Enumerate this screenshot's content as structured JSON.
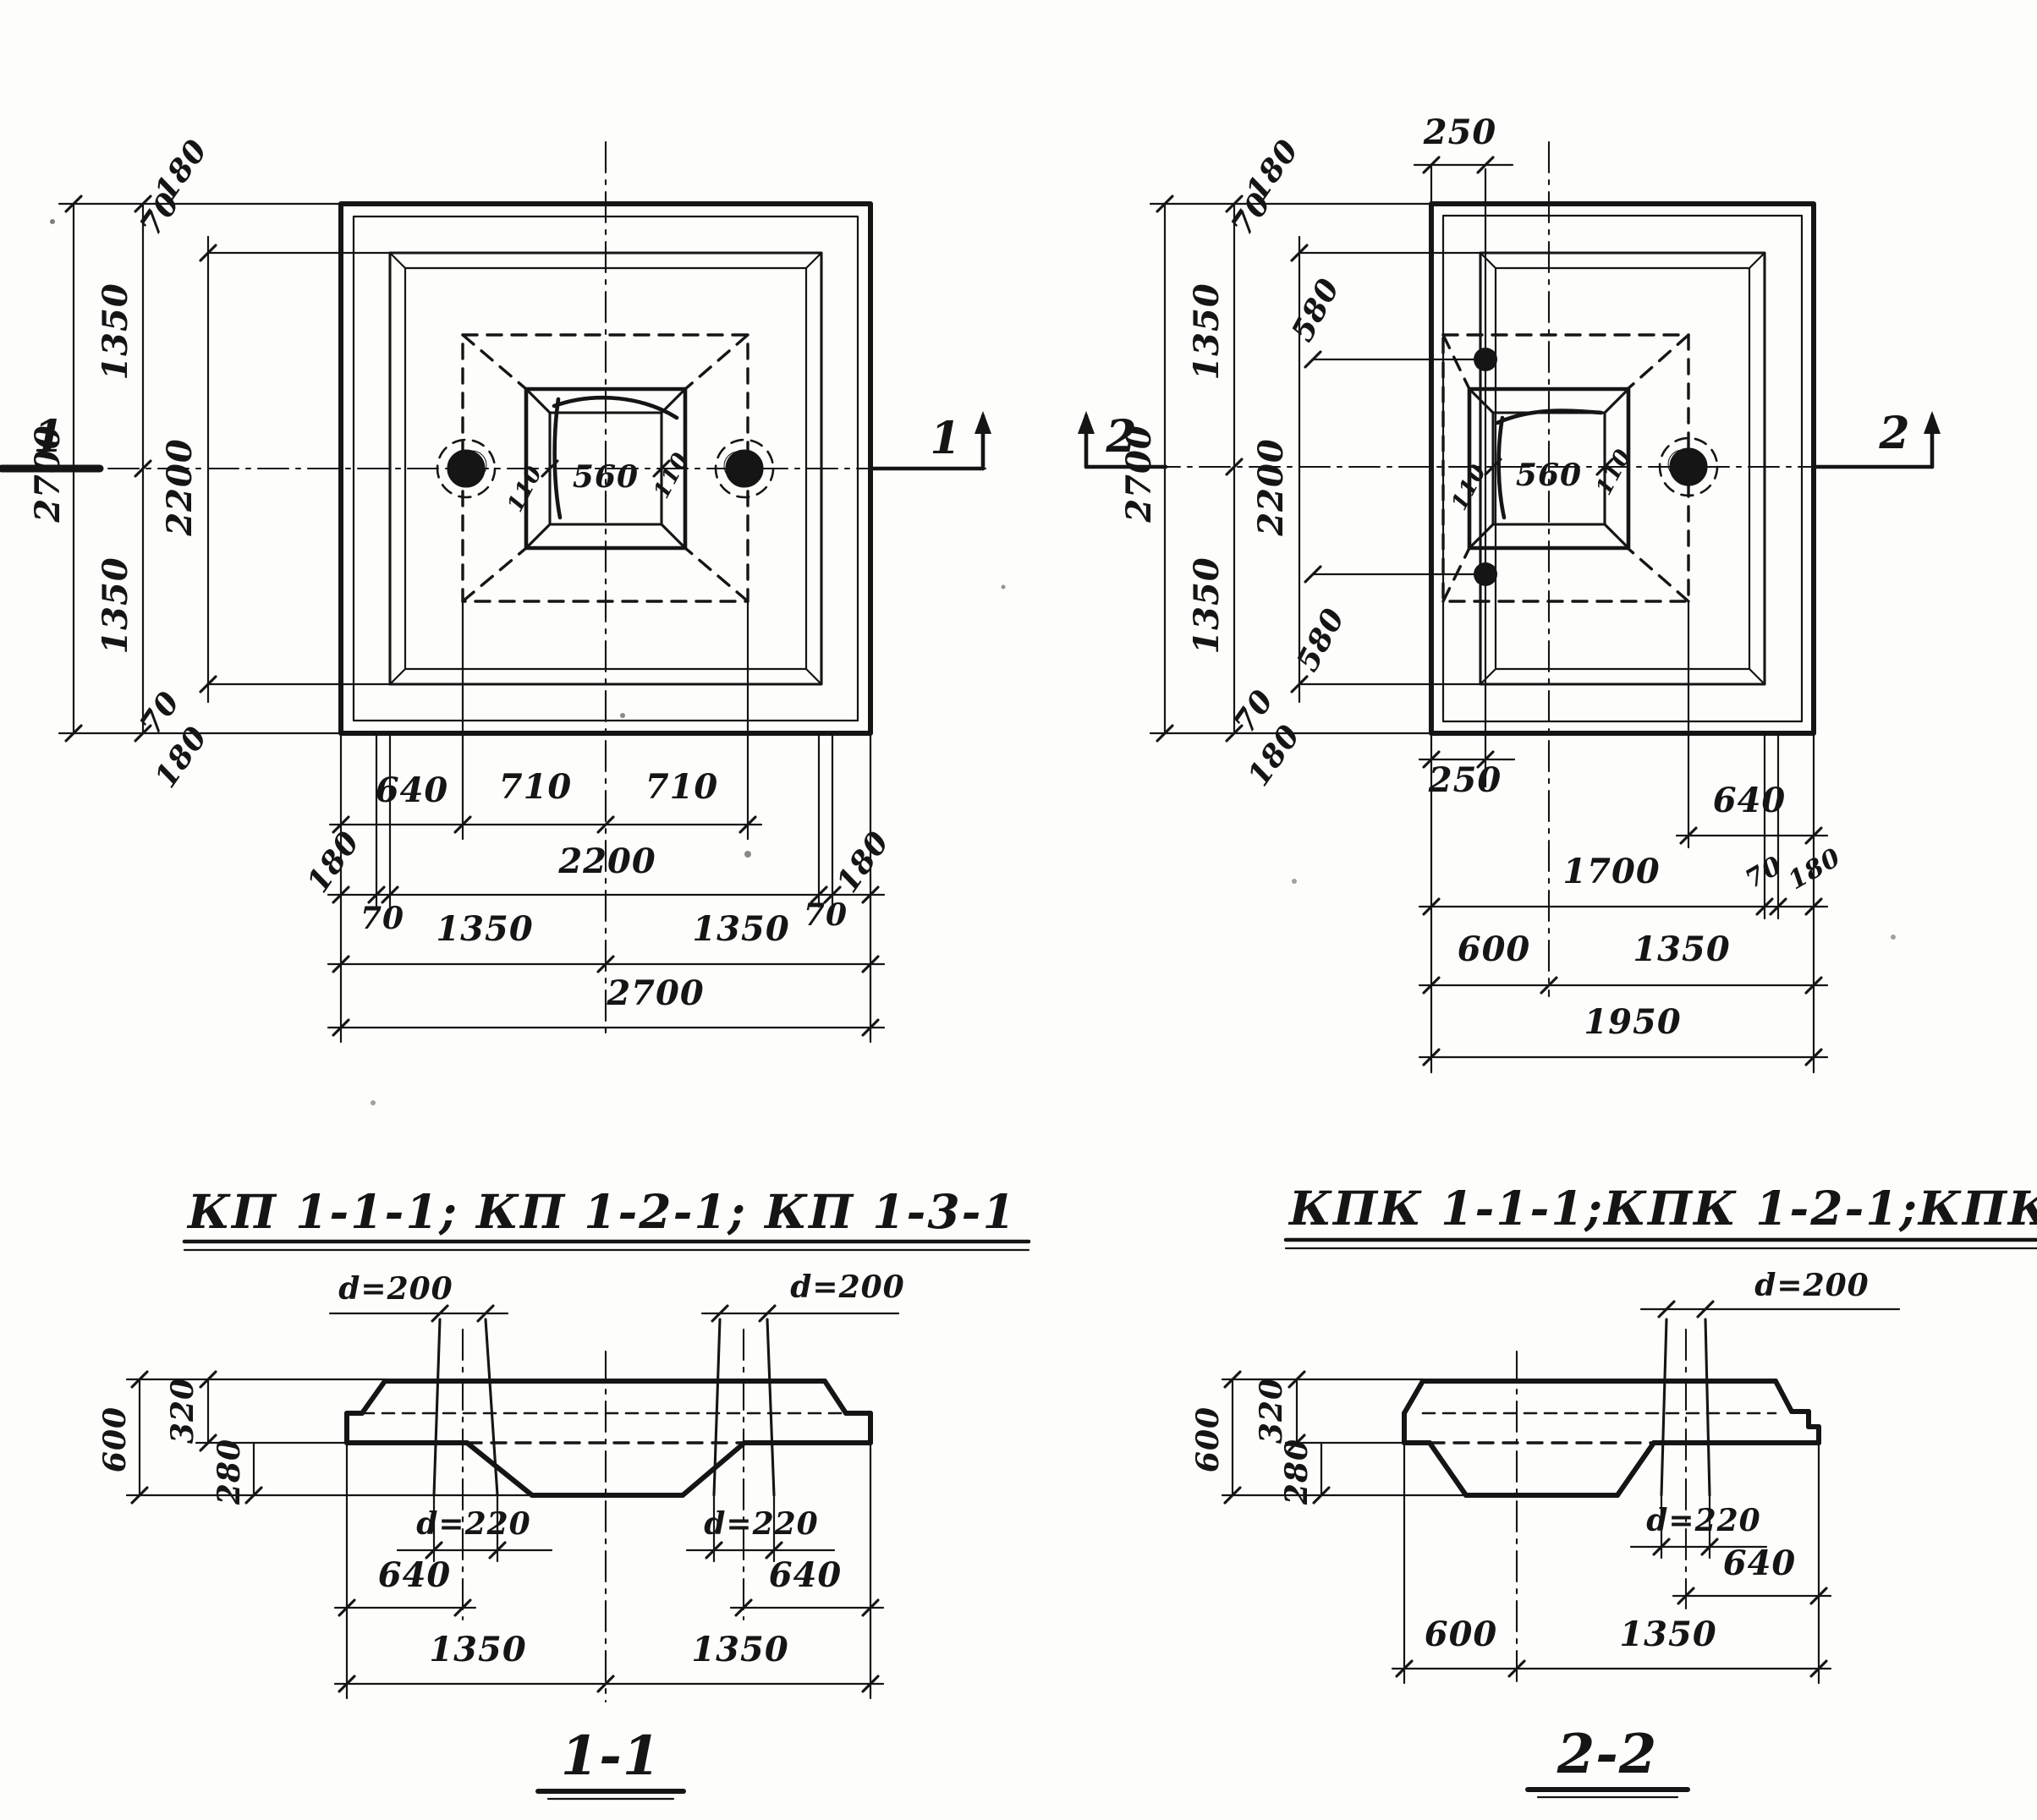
{
  "plan_left": {
    "mark_left": "1",
    "mark_right": "1",
    "stack": {
      "v2700": "2700",
      "v1350t": "1350",
      "v1350b": "1350",
      "v2200": "2200",
      "t180": "180",
      "t70": "70",
      "b70": "70",
      "b180": "180"
    },
    "socket": {
      "l110": "110",
      "c560": "560",
      "r110": "110"
    },
    "bottom": {
      "r1_640": "640",
      "r1_710a": "710",
      "r1_710b": "710",
      "r2_180l": "180",
      "r2_70l": "70",
      "r2_2200": "2200",
      "r2_70r": "70",
      "r2_180r": "180",
      "r3_1350a": "1350",
      "r3_1350b": "1350",
      "r4_2700": "2700"
    }
  },
  "plan_right": {
    "mark_left": "2",
    "mark_right": "2",
    "top250": "250",
    "stack": {
      "v2700": "2700",
      "v1350t": "1350",
      "v1350b": "1350",
      "v2200": "2200",
      "t180": "180",
      "t70": "70",
      "t580": "580",
      "b580": "580",
      "b70": "70",
      "b180": "180"
    },
    "socket": {
      "l110": "110",
      "c560": "560",
      "r110": "110"
    },
    "bottom": {
      "b250": "250",
      "b640": "640",
      "r2_1700": "1700",
      "r2_70": "70",
      "r2_180": "180",
      "r3_600": "600",
      "r3_1350": "1350",
      "r4_1950": "1950"
    }
  },
  "titles": {
    "left": "КП 1-1-1; КП 1-2-1;  КП 1-3-1",
    "right": "КПК 1-1-1;КПК 1-2-1;КПК 1-3-1"
  },
  "section1": {
    "title": "1-1",
    "d200l": "d=200",
    "d200r": "d=200",
    "d220l": "d=220",
    "d220r": "d=220",
    "v600": "600",
    "v320": "320",
    "v280": "280",
    "b640l": "640",
    "b640r": "640",
    "b1350l": "1350",
    "b1350r": "1350"
  },
  "section2": {
    "title": "2-2",
    "d200": "d=200",
    "d220": "d=220",
    "v600": "600",
    "v320": "320",
    "v280": "280",
    "b640": "640",
    "b600": "600",
    "b1350": "1350"
  }
}
